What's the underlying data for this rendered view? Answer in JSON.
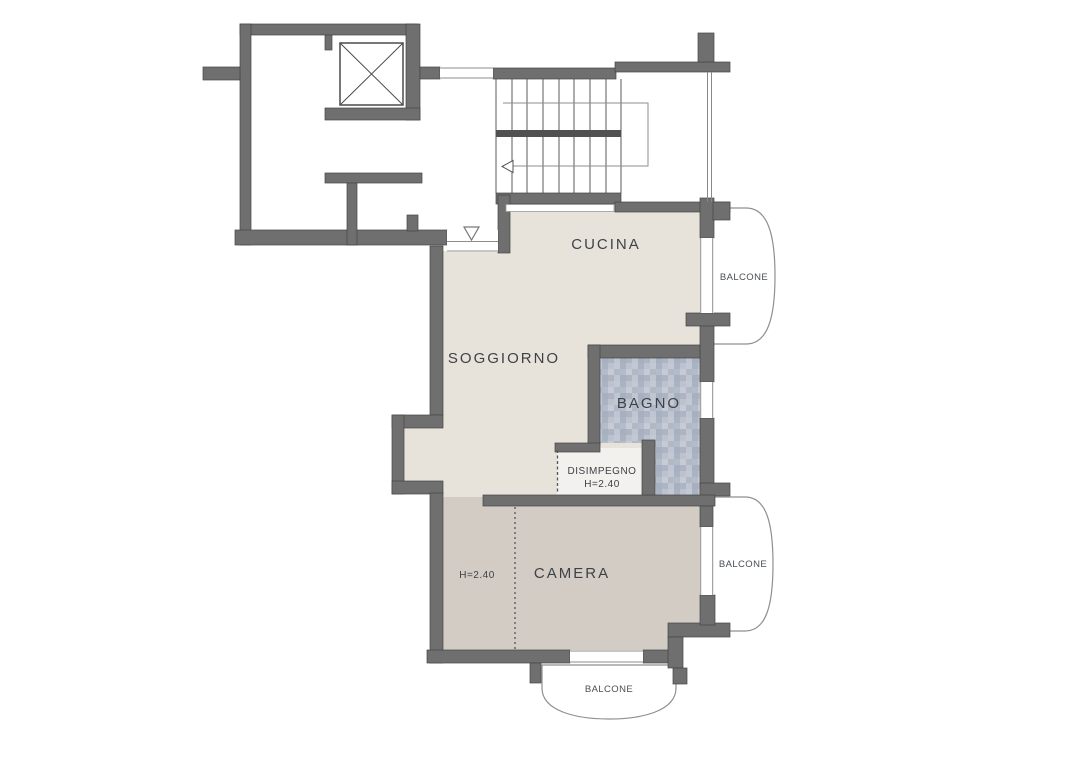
{
  "document": {
    "type": "floor-plan",
    "language": "it",
    "background_color": "#ffffff"
  },
  "colors": {
    "wall": "#6f6f6f",
    "wall_outline": "#454545",
    "living_area_fill": "#e8e3da",
    "bedroom_fill": "#d3ccc4",
    "bathroom_tile_base": "#b9c0cc",
    "hallway_fill": "#f2f1ee",
    "label_text": "#3d4247",
    "thin_outline": "#8f8f8f"
  },
  "floorplan": {
    "rooms": [
      {
        "id": "cucina",
        "label": "CUCINA"
      },
      {
        "id": "soggiorno",
        "label": "SOGGIORNO"
      },
      {
        "id": "bagno",
        "label": "BAGNO"
      },
      {
        "id": "disimpegno",
        "label": "DISIMPEGNO",
        "height_annotation": "H=2.40"
      },
      {
        "id": "camera",
        "label": "CAMERA",
        "height_annotation": "H=2.40"
      }
    ],
    "balconies": [
      {
        "id": "balcone-cucina",
        "label": "BALCONE"
      },
      {
        "id": "balcone-camera",
        "label": "BALCONE"
      },
      {
        "id": "balcone-sud",
        "label": "BALCONE"
      }
    ],
    "symbols": [
      "elevator-shaft-x",
      "staircase-treads",
      "stair-direction-arrow",
      "entrance-marker-triangle",
      "camera-partition-dotted-line",
      "disimpegno-boundary-dashed-line"
    ]
  }
}
